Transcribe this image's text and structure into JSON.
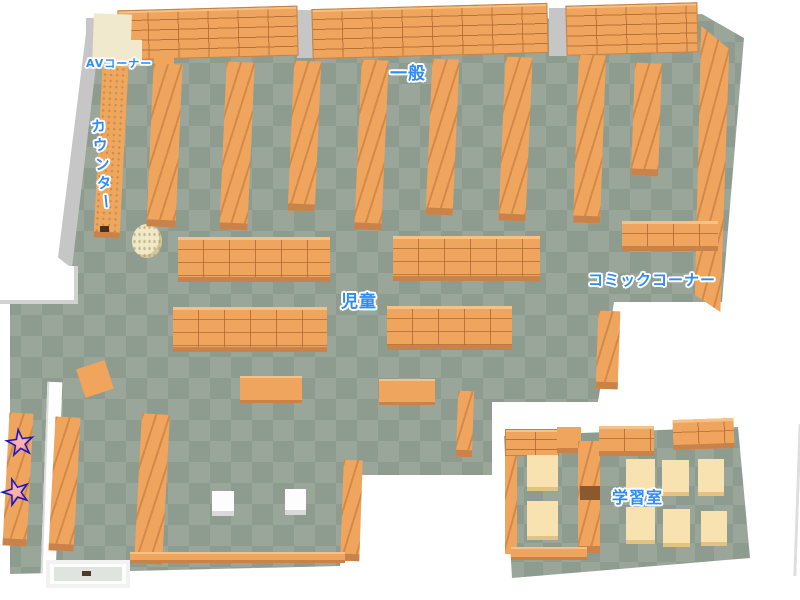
{
  "areas": [
    {
      "id": "av-corner",
      "label": "AVコーナー"
    },
    {
      "id": "general",
      "label": "一般"
    },
    {
      "id": "counter",
      "label": "カウンター"
    },
    {
      "id": "children",
      "label": "児童"
    },
    {
      "id": "comic-corner",
      "label": "コミックコーナー"
    },
    {
      "id": "study-room",
      "label": "学習室"
    }
  ],
  "markers": {
    "stars": [
      {
        "name": "star-marker-1"
      },
      {
        "name": "star-marker-2"
      }
    ],
    "fill": "#f3766e",
    "outline": "#1518c8"
  },
  "colors": {
    "background": "#ffffff",
    "floor_light": "#99a699",
    "floor_dark": "#8d9c8f",
    "shelf_top": "#f0a55e",
    "shelf_side": "#c9834a",
    "wall": "#ffffff",
    "wall_shade": "#c6c6c6",
    "table": "#f8e3b0",
    "av_shelf": "#f1e9cd",
    "label_text": "#2e8bf7",
    "label_outline": "#ffffff"
  }
}
